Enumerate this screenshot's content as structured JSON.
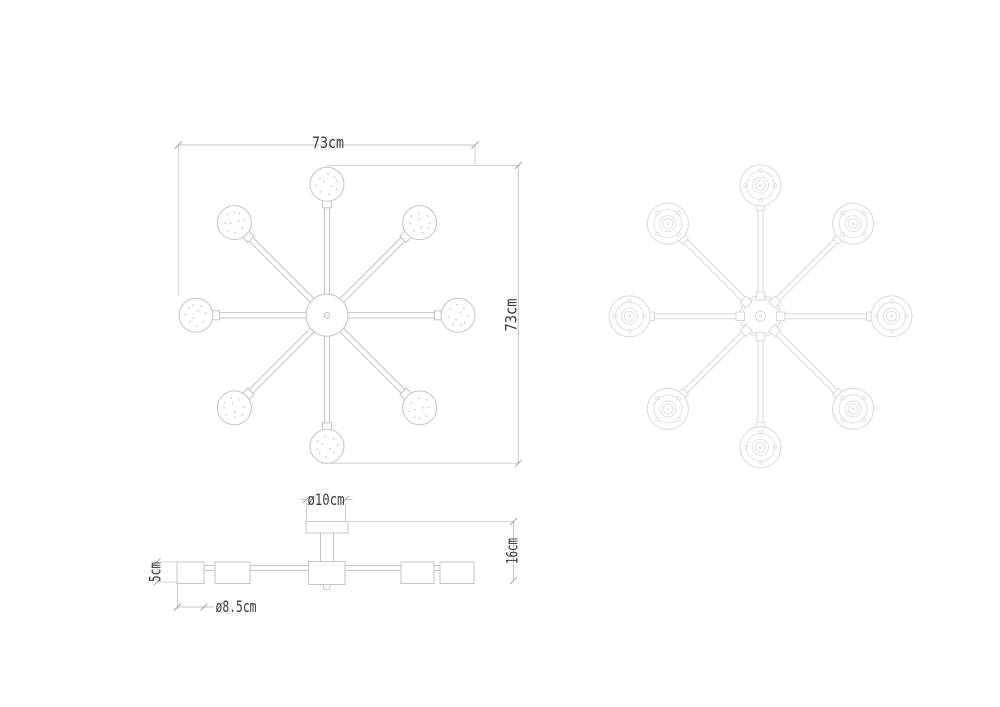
{
  "drawing": {
    "subject": "8-arm ceiling chandelier technical drawing",
    "arm_count": 8,
    "views": [
      "top",
      "bottom",
      "side"
    ]
  },
  "dimensions": {
    "width": "73cm",
    "height": "73cm",
    "canopy_diameter": "ø10cm",
    "fixture_height": "16cm",
    "shade_height": "5cm",
    "shade_diameter": "ø8.5cm"
  },
  "colors": {
    "background": "#ffffff",
    "top_view_line": "#c3c3c3",
    "bottom_view_line": "#d8d8d8",
    "side_view_line": "#c6c6c6",
    "dimension_line": "#c4c4c4",
    "tick": "#a5a5a5",
    "text": "#3b3b3b"
  }
}
